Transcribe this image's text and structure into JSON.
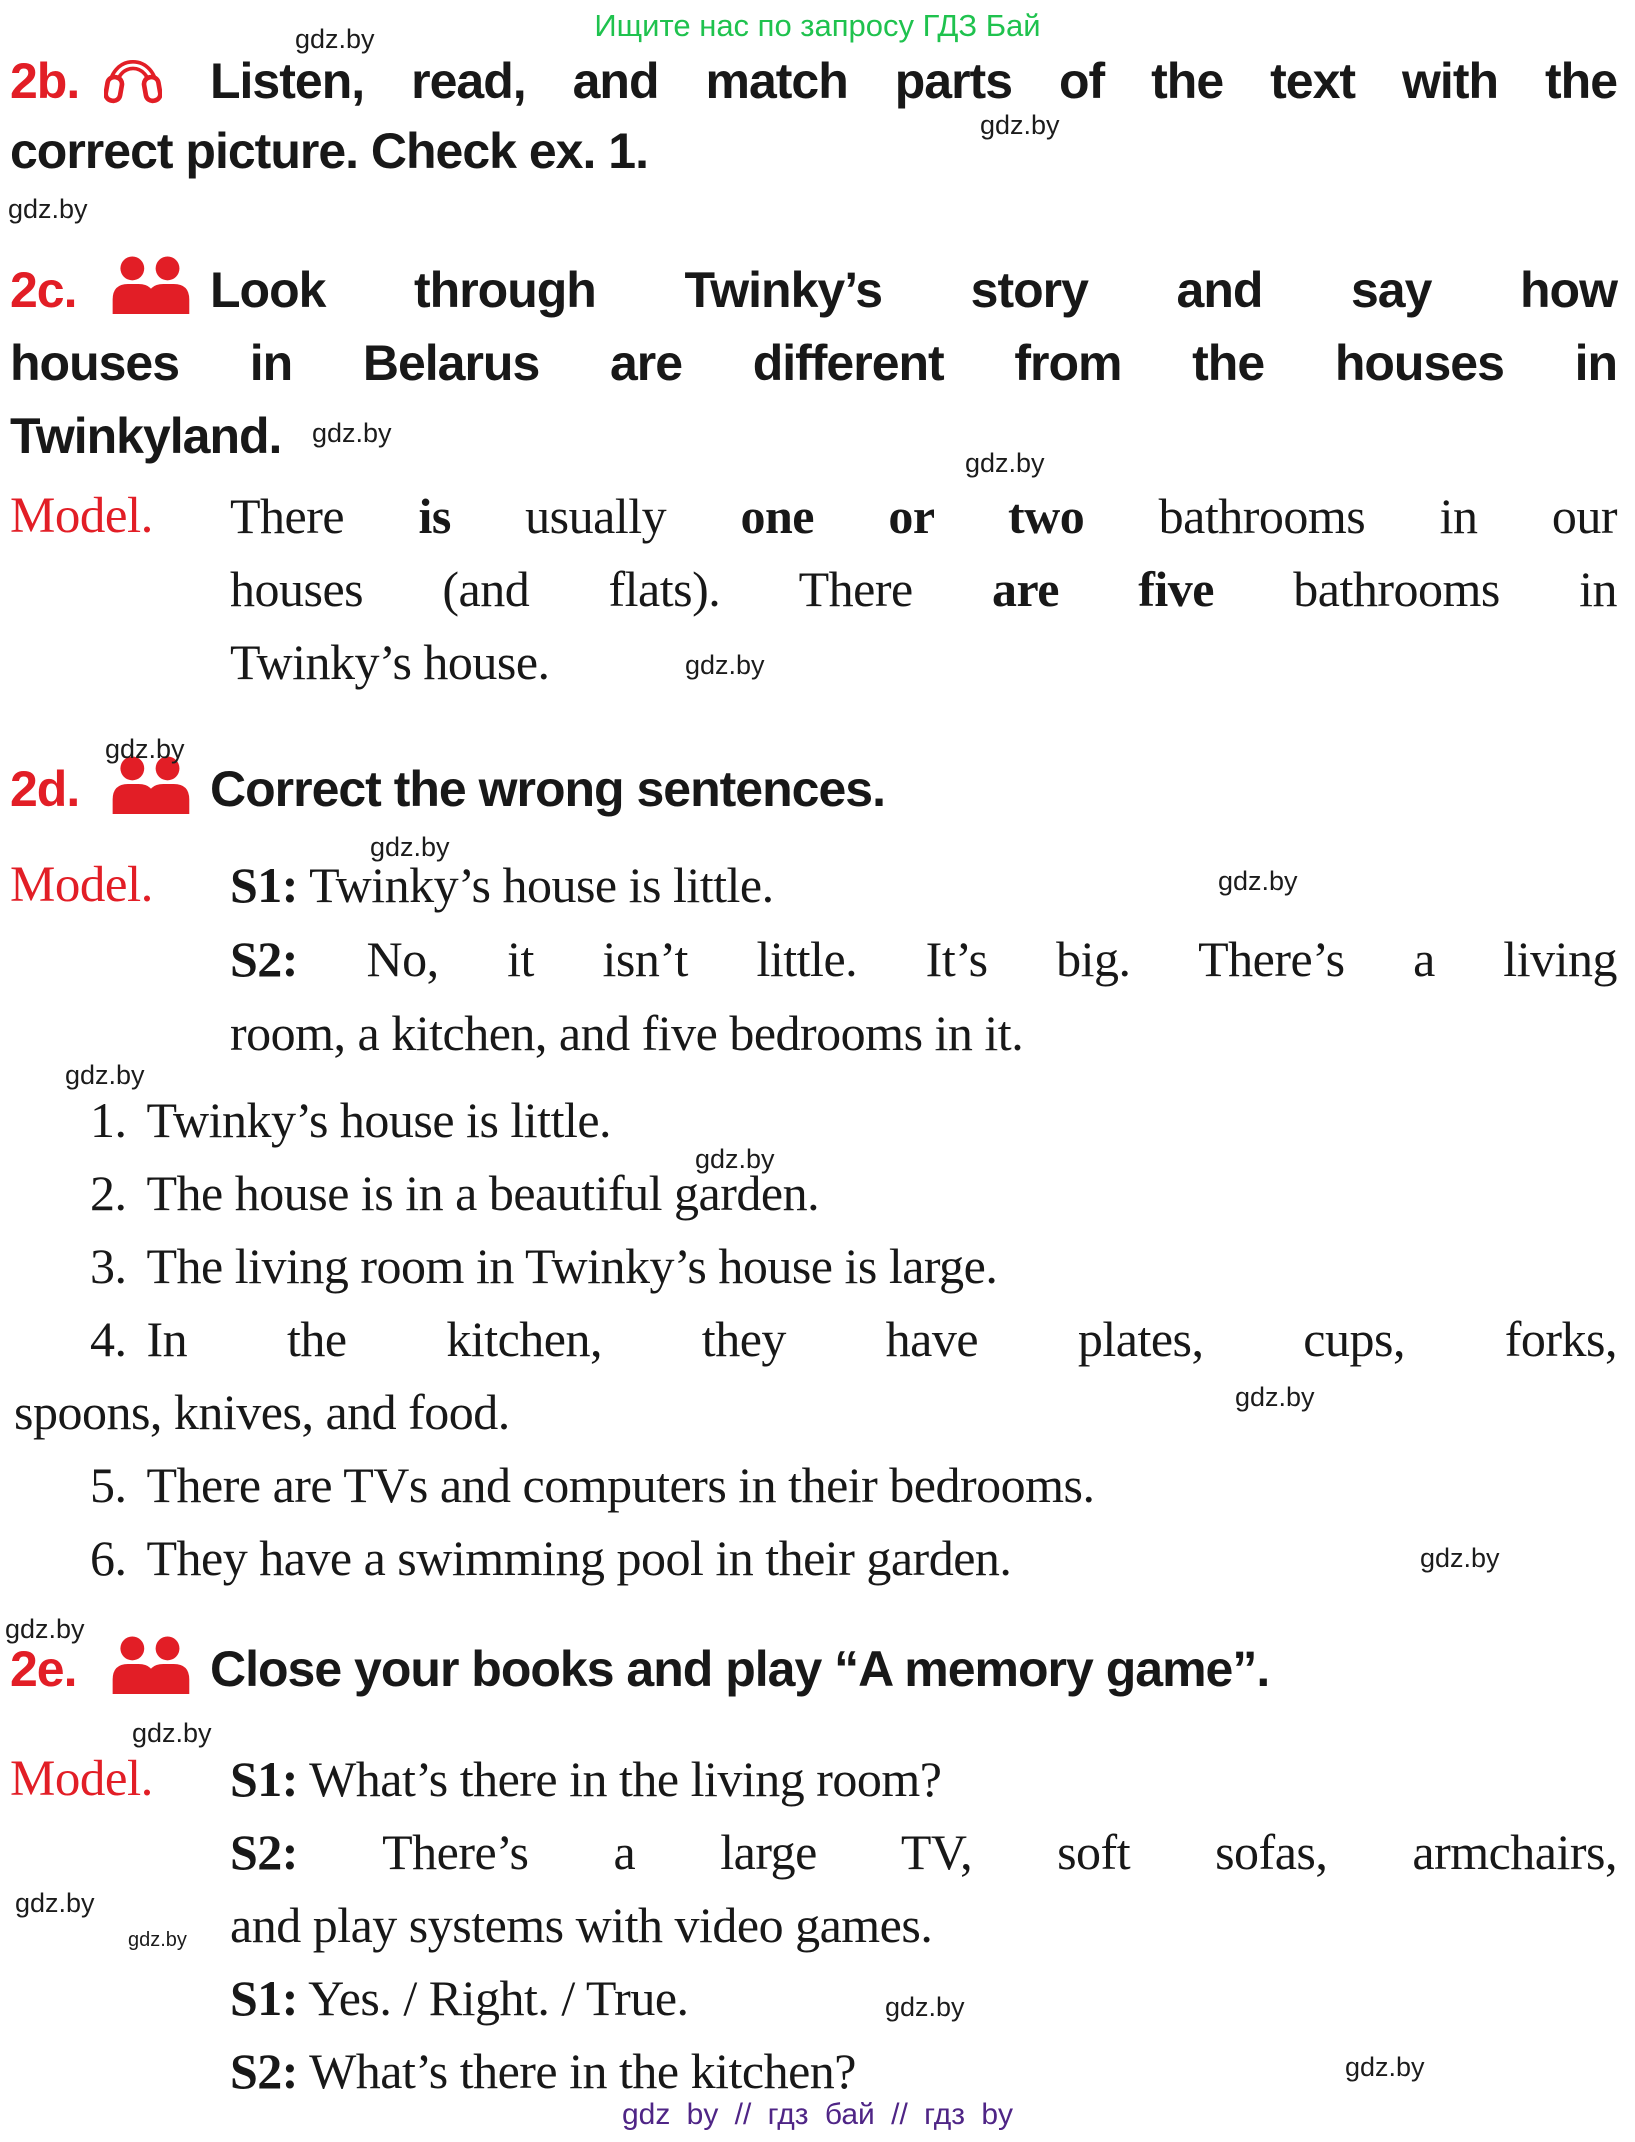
{
  "page": {
    "top_banner": "Ищите нас по запросу ГДЗ Бай",
    "footer": "gdz by  //  гдз бай  //  гдз by",
    "watermark": "gdz.by",
    "colors": {
      "red": "#e21e26",
      "green": "#1fc24e",
      "purple": "#4f2586",
      "ink": "#181818"
    }
  },
  "sections": {
    "ex2b": {
      "label": "2b.",
      "icon": "headphones-icon",
      "lines": [
        "Listen, read, and match parts of the text with the",
        "correct picture. Check ex. 1."
      ]
    },
    "ex2c": {
      "label": "2c.",
      "icon": "people-icon",
      "lines": [
        "Look through Twinky’s story and say how",
        "houses in Belarus are different from the houses in",
        "Twinkyland."
      ]
    },
    "model2c": {
      "label": "Model.",
      "lines": [
        [
          [
            "There ",
            0
          ],
          [
            "is",
            1
          ],
          [
            " usually ",
            0
          ],
          [
            "one or two",
            1
          ],
          [
            " bathrooms in our",
            0
          ]
        ],
        [
          [
            "houses (and flats). There ",
            0
          ],
          [
            "are five",
            1
          ],
          [
            " bathrooms in",
            0
          ]
        ],
        [
          [
            "Twinky’s house.",
            0
          ]
        ]
      ]
    },
    "ex2d": {
      "label": "2d.",
      "icon": "people-icon",
      "lines": [
        "Correct the wrong sentences."
      ]
    },
    "model2d": {
      "label": "Model.",
      "lines": [
        [
          [
            "S1:",
            1
          ],
          [
            " Twinky’s house is little.",
            0
          ]
        ],
        [
          [
            "S2:",
            1
          ],
          [
            " No, it isn’t little. It’s big. There’s a living",
            0
          ]
        ],
        [
          [
            "room, a kitchen, and five bedrooms in it.",
            0
          ]
        ]
      ]
    },
    "list": {
      "lines": [
        {
          "num": "1.",
          "text": "Twinky’s house is little."
        },
        {
          "num": "2.",
          "text": "The house is in a beautiful garden."
        },
        {
          "num": "3.",
          "text": "The living room in Twinky’s house is large."
        },
        {
          "num": "4.",
          "text": "In the kitchen, they have plates, cups, forks,"
        },
        {
          "num": "",
          "text": "spoons, knives, and food."
        },
        {
          "num": "5.",
          "text": "There are TVs and computers in their bedrooms."
        },
        {
          "num": "6.",
          "text": "They have a swimming pool in their garden."
        }
      ]
    },
    "ex2e": {
      "label": "2e.",
      "icon": "people-icon",
      "lines": [
        "Close your books and play “A memory game”."
      ]
    },
    "model2e": {
      "label": "Model.",
      "lines": [
        [
          [
            "S1:",
            1
          ],
          [
            " What’s there in the living room?",
            0
          ]
        ],
        [
          [
            "S2:",
            1
          ],
          [
            " There’s a large TV, soft sofas, armchairs,",
            0
          ]
        ],
        [
          [
            "and play systems with video games.",
            0
          ]
        ],
        [
          [
            "S1:",
            1
          ],
          [
            " Yes. / Right. / True.",
            0
          ]
        ],
        [
          [
            "S2:",
            1
          ],
          [
            " What’s there in the kitchen?",
            0
          ]
        ]
      ]
    }
  },
  "watermarks": [
    {
      "x": 295,
      "y": 26
    },
    {
      "x": 980,
      "y": 112
    },
    {
      "x": 8,
      "y": 196
    },
    {
      "x": 312,
      "y": 420
    },
    {
      "x": 965,
      "y": 450
    },
    {
      "x": 685,
      "y": 652
    },
    {
      "x": 105,
      "y": 736
    },
    {
      "x": 370,
      "y": 834
    },
    {
      "x": 1218,
      "y": 868
    },
    {
      "x": 65,
      "y": 1062
    },
    {
      "x": 695,
      "y": 1146
    },
    {
      "x": 1235,
      "y": 1384
    },
    {
      "x": 1420,
      "y": 1545
    },
    {
      "x": 5,
      "y": 1616
    },
    {
      "x": 132,
      "y": 1720
    },
    {
      "x": 15,
      "y": 1890
    },
    {
      "x": 128,
      "y": 1930,
      "s": 1
    },
    {
      "x": 885,
      "y": 1994
    },
    {
      "x": 1345,
      "y": 2054
    }
  ]
}
